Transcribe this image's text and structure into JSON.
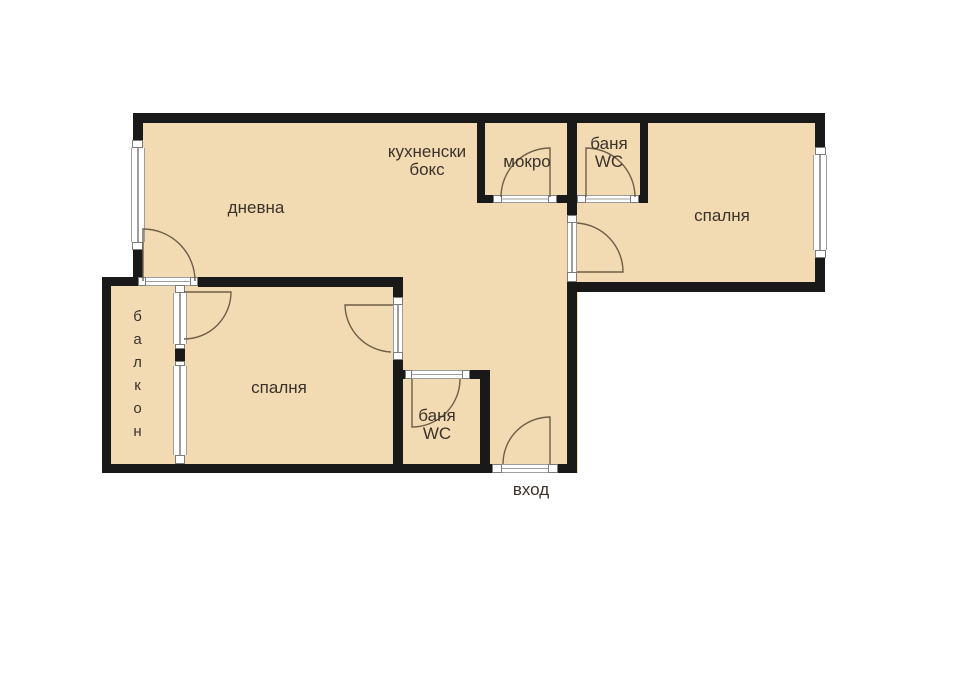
{
  "title": "apartment floor plan",
  "colors": {
    "floor": "#f2dbb2",
    "wall": "#191919",
    "door": "#6e5e49",
    "glassline": "#9e9e9e",
    "ink": "#3a322b"
  },
  "rooms": {
    "living": {
      "label": "дневна"
    },
    "kitchen": {
      "line1": "кухненски",
      "line2": "бокс"
    },
    "wet_room": {
      "label": "мокро"
    },
    "bathroom_top": {
      "line1": "баня",
      "line2": "WC"
    },
    "bedroom_right": {
      "label": "спалня"
    },
    "bedroom_left": {
      "label": "спалня"
    },
    "bathroom_bottom": {
      "line1": "баня",
      "line2": "WC"
    },
    "balcony": {
      "label": "балкон"
    },
    "entrance": {
      "label": "вход"
    }
  }
}
